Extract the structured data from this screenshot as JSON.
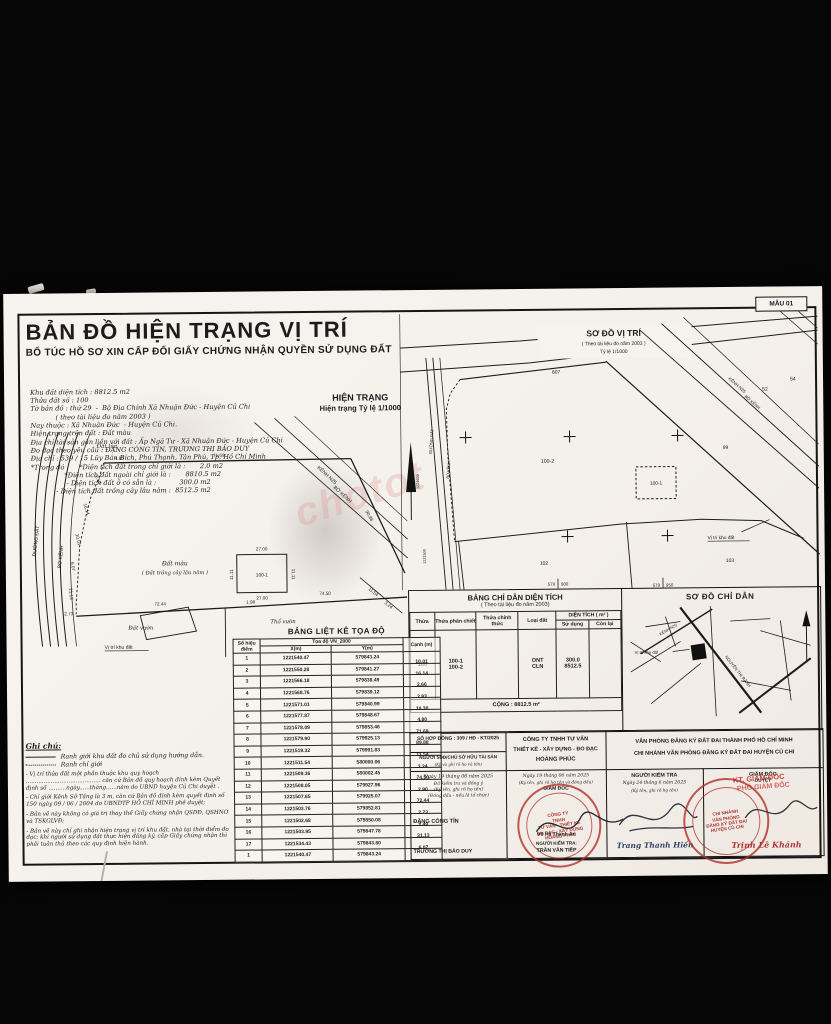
{
  "page": {
    "watermark": "chotot",
    "form_code": "MẪU 01"
  },
  "colors": {
    "paper": "#f6f3ef",
    "ink": "#1c1c1c",
    "stamp_red": "#b03434",
    "signature_blue": "#31436b"
  },
  "header": {
    "title": "BẢN ĐỒ HIỆN TRẠNG VỊ TRÍ",
    "subtitle": "BỔ TÚC HỒ SƠ XIN CẤP ĐỔI GIẤY CHỨNG NHẬN QUYỀN SỬ DỤNG ĐẤT",
    "meta_lines": [
      "Khu đất diện tích : 8812.5 m2",
      "Thửa đất số : 100",
      "Tờ bản đồ : thứ 29  -  Bộ Địa Chính Xã Nhuận Đức - Huyện Củ Chi",
      "            ( theo tài liệu đo năm 2003 )",
      "Nay thuộc : Xã Nhuận Đức  - Huyện Củ Chi.",
      "Hiện trạng trên đất : Đất màu",
      "Địa chỉ tài sản gắn liền với đất : Ấp Ngã Tư - Xã Nhuận Đức - Huyện Củ Chi",
      "Đo đạc theo yêu cầu : ĐẶNG CÔNG TÍN, TRƯƠNG THỊ BẢO DUY",
      "Địa chỉ : 539 / 15 Lũy Bán Bích, Phú Thạnh, Tân Phú, Tp. Hồ Chí Minh",
      "*Trong đó :     *Diện tích đất trong chỉ giới là :       2.0 m2",
      "                *Diện tích đất ngoài chỉ giới là :       8810.5 m2",
      "                 - Diện tích đất ở có sẵn là :           300.0 m2",
      "            - Diện tích đất trồng cây lâu năm :  8512.5 m2"
    ],
    "status_label": "HIỆN TRẠNG",
    "status_scale": "Hiện trạng Tỷ lệ 1/1000"
  },
  "left_map": {
    "labels": {
      "dat_lua": "Đất lúa",
      "dat_mau": "Đất màu",
      "dat_mau2": "( Đất trồng cây lâu năm )",
      "dat_vuon": "Đất vườn",
      "tho_vuon": "Thổ vườn",
      "vi_tri": "Vị trí khu đất",
      "duong_dat": "ĐƯỜNG ĐẤT",
      "bo_kenh": "BỜ KÊNH",
      "kenh": "KÊNH N25",
      "bo_kenh2": "BỜ KÊNH",
      "plot": "100-1"
    },
    "dims": {
      "top": "71.69",
      "d1": "4.80",
      "d2": "2.53",
      "d3": "16.14",
      "d4": "10.01",
      "d5": "6.07",
      "d6": "21.13",
      "d7": "2.73",
      "b1": "72.44",
      "b2": "1.98",
      "b3": "74.50",
      "diag": "90.86",
      "d8": "11.54",
      "d9": "3.24",
      "rw1": "27.00",
      "rw2": "27.00",
      "rh1": "11.11",
      "rh2": "11.11"
    }
  },
  "right_map": {
    "title": "SƠ ĐỒ VỊ TRÍ",
    "subtitle": "( Theo tài liệu đo năm 2003 )",
    "scale": "Tỷ lệ 1/1000",
    "plots": {
      "p607": "607",
      "p54": "54",
      "p52": "52",
      "p99": "99",
      "p100_2": "100-2",
      "p100_1": "100-1",
      "p102": "102",
      "p103": "103"
    },
    "roads": {
      "duong_dat": "ĐƯỜNG ĐẤT",
      "bo_kenh": "BỜ KÊNH",
      "kenh": "KÊNH N25",
      "bo_kenh2": "BỜ KÊNH"
    },
    "vi_tri": "Vị trí khu đất",
    "grid": {
      "g1a": "579",
      "g1b": "900",
      "g2a": "579",
      "g2b": "950",
      "v1": "1221600",
      "v2": "1221500"
    }
  },
  "area_table": {
    "title": "BẢNG CHỈ DẪN DIỆN TÍCH",
    "subtitle": "( Theo tài liệu đo năm 2003)",
    "headers": {
      "thua": "Thửa",
      "phan_chiet": "Thửa phân chiết",
      "chinh_thuc": "Thửa chính thức",
      "loai_dat": "Loại đất",
      "dien_tich": "DIỆN TÍCH ( m² )",
      "su_dung": "Sử dụng",
      "con_lai": "Còn lại"
    },
    "row": {
      "thua": "100",
      "pc1": "100-1",
      "pc2": "100-2",
      "ld1": "ONT",
      "ld2": "CLN",
      "sd1": "300.0",
      "sd2": "8512.5"
    },
    "total": "CỘNG : 8812.5 m²"
  },
  "guide_map": {
    "title": "SƠ ĐỒ CHỈ DẪN",
    "site_label": "Vị trí khu đất",
    "street1": "NGUYỄN THỊ RÀNH",
    "street2": "KÊNH N25"
  },
  "coord_table": {
    "title": "BẢNG LIỆT KÊ TỌA ĐỘ",
    "headers": {
      "point": "Số hiệu điểm",
      "group": "Tọa độ VN_2000",
      "x": "X(m)",
      "y": "Y(m)",
      "edge": "Cạnh (m)"
    },
    "rows": [
      {
        "p": "1",
        "x": "1221540.47",
        "y": "579843.24",
        "c": "10.01"
      },
      {
        "p": "2",
        "x": "1221550.28",
        "y": "579841.27",
        "c": "16.14"
      },
      {
        "p": "3",
        "x": "1221566.18",
        "y": "579838.49",
        "c": "2.66"
      },
      {
        "p": "4",
        "x": "1221568.76",
        "y": "579839.12",
        "c": "2.93"
      },
      {
        "p": "5",
        "x": "1221571.01",
        "y": "579840.99",
        "c": "10.30"
      },
      {
        "p": "6",
        "x": "1221577.87",
        "y": "579848.67",
        "c": "4.80"
      },
      {
        "p": "7",
        "x": "1221578.09",
        "y": "579853.46",
        "c": "71.69"
      },
      {
        "p": "8",
        "x": "1221579.90",
        "y": "579925.13",
        "c": "89.88"
      },
      {
        "p": "9",
        "x": "1221519.32",
        "y": "579991.83",
        "c": "11.54"
      },
      {
        "p": "10",
        "x": "1221511.54",
        "y": "580000.06",
        "c": "3.24"
      },
      {
        "p": "11",
        "x": "1221509.36",
        "y": "580002.45",
        "c": "74.50"
      },
      {
        "p": "12",
        "x": "1221508.05",
        "y": "579927.96",
        "c": "2.90"
      },
      {
        "p": "13",
        "x": "1221507.65",
        "y": "579925.07",
        "c": "72.44"
      },
      {
        "p": "14",
        "x": "1221503.76",
        "y": "579852.81",
        "c": "2.73"
      },
      {
        "p": "15",
        "x": "1221502.68",
        "y": "579850.08",
        "c": "2.49"
      },
      {
        "p": "16",
        "x": "1221503.95",
        "y": "579847.78",
        "c": "31.13"
      },
      {
        "p": "17",
        "x": "1221534.43",
        "y": "579843.80",
        "c": "6.07"
      },
      {
        "p": "1",
        "x": "1221540.47",
        "y": "579843.24",
        "c": ""
      }
    ]
  },
  "notes": {
    "title": "Ghi chú:",
    "legend_solid": "Ranh giới khu đất đo chủ sử dụng hướng dẫn.",
    "legend_dotted": "Ranh chỉ giới",
    "paragraphs": [
      "- Vị trí thửa đất một phần thuộc khu quy hoạch .......................................... căn cứ Bản đồ quy hoạch đính kèm Quyết định số ..........ngày......tháng......năm do UBND huyện Củ Chi duyệt .",
      "- Chỉ giới Kênh Sở Tầng là 3 m, căn cứ Bản đồ đính kèm quyết định số 150 ngày 09 / 06 / 2004 do UBNDTP HỒ CHÍ MINH phê duyệt;",
      "- Bản vẽ này không có giá trị thay thế Giấy chứng nhận QSDĐ, QSHNƠ và TSKGLVĐ;",
      "- Bản vẽ này chỉ ghi nhận hiện trạng vị trí khu đất, nhà tại thời điểm đo đạc; khi người sử dụng đất thực hiện đăng ký, cấp Giấy chứng nhận thì phải tuân thủ theo các quy định hiện hành."
    ]
  },
  "signatures": {
    "contract": "SỐ HỢP ĐỒNG : 309 / HĐ - KT/2025",
    "owner_title": "NGƯỜI SDĐ/CHỦ SỞ HỮU TÀI SẢN",
    "owner_sub": "(Ký và ghi rõ họ và tên)",
    "owner_date": "Ngày 19 tháng 06 năm 2025",
    "owner_note1": "Đã kiểm tra và đồng ý",
    "owner_note2": "(Ký tên, ghi rõ họ tên)",
    "owner_note3": "(Đóng dấu - nếu là tổ chức)",
    "owner_name": "ĐẶNG CÔNG TÍN",
    "owner_name2": "TRƯƠNG THỊ BẢO DUY",
    "company_line1": "CÔNG TY TNHH TƯ VẤN",
    "company_line2": "THIẾT KẾ - XÂY DỰNG - ĐO ĐẠC",
    "company_line3": "HOÀNG PHÚC",
    "company_date": "Ngày 19  tháng  06  năm 2025",
    "company_sub": "(Ký tên, ghi rõ họ tên và đóng dấu)",
    "company_role": "GIÁM ĐỐC",
    "company_sign": "Võ Hà Thanh An",
    "company_checker_label": "NGƯỜI KIỂM TRA:",
    "company_checker": "TRẦN VĂN TIẾP",
    "office_line1": "VĂN PHÒNG ĐĂNG KÝ ĐẤT ĐAI THÀNH PHỐ HỒ CHÍ MINH",
    "office_line2": "CHI NHÁNH VĂN PHÒNG ĐĂNG KÝ ĐẤT ĐAI  HUYỆN CỦ CHI",
    "checker_title": "NGƯỜI KIỂM TRA",
    "checker_date": "Ngày 24 tháng 6 năm 2025",
    "checker_sub": "(Ký tên, ghi rõ họ tên)",
    "checker_name": "Trang Thanh Hiền",
    "director_title": "GIÁM ĐỐC",
    "director_sub": "DUYỆT",
    "stamp_kt1": "KT. GIÁM ĐỐC",
    "stamp_kt2": "PHÓ GIÁM ĐỐC",
    "director_name": "Trịnh Lê Khánh",
    "company_stamp": [
      "CÔNG TY",
      "TNHH",
      "TƯ VẤN - THIẾT KẾ",
      "ĐO ĐẠC - XÂY DỰNG",
      "HOÀNG PHÚC"
    ],
    "branch_stamp": [
      "CHI NHÁNH",
      "VĂN PHÒNG",
      "ĐĂNG KÝ ĐẤT ĐAI",
      "HUYỆN CỦ CHI"
    ]
  }
}
